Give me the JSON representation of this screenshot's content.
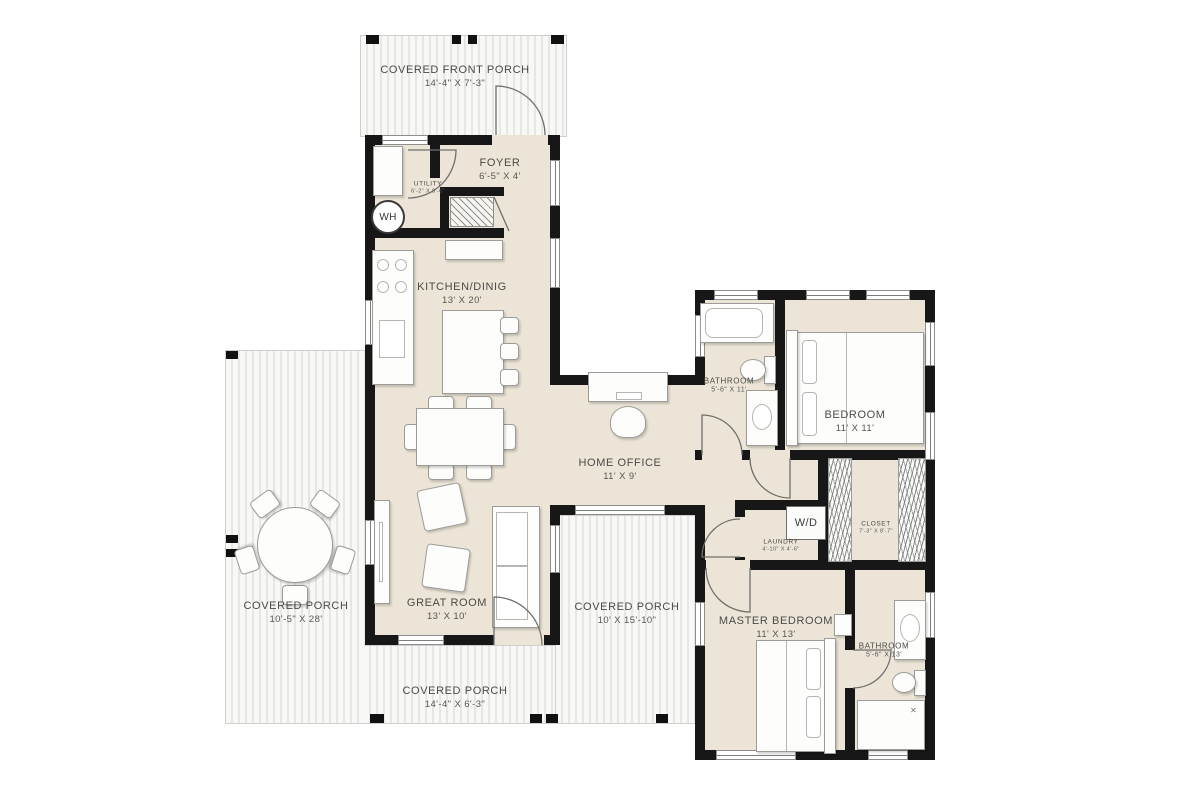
{
  "floorplan": {
    "rooms": [
      {
        "id": "covered-front-porch",
        "name": "COVERED FRONT PORCH",
        "dims": "14'-4\" X 7'-3\""
      },
      {
        "id": "foyer",
        "name": "FOYER",
        "dims": "6'-5\" X 4'"
      },
      {
        "id": "utility",
        "name": "UTILITY",
        "dims": "6'-2\" X 8'-6\""
      },
      {
        "id": "kitchen-dining",
        "name": "KITCHEN/DINIG",
        "dims": "13' X 20'"
      },
      {
        "id": "home-office",
        "name": "HOME OFFICE",
        "dims": "11' X 9'"
      },
      {
        "id": "bathroom-1",
        "name": "BATHROOM",
        "dims": "5'-6\" X 11'"
      },
      {
        "id": "bedroom",
        "name": "BEDROOM",
        "dims": "11' X 11'"
      },
      {
        "id": "laundry",
        "name": "LAUNDRY",
        "dims": "4'-10\" X 4'-6\""
      },
      {
        "id": "closet",
        "name": "CLOSET",
        "dims": "7'-3\" X 8'-7\""
      },
      {
        "id": "great-room",
        "name": "GREAT ROOM",
        "dims": "13' X 10'"
      },
      {
        "id": "covered-porch-left",
        "name": "COVERED PORCH",
        "dims": "10'-5\" X 28'"
      },
      {
        "id": "covered-porch-mid",
        "name": "COVERED PORCH",
        "dims": "10' X 15'-10\""
      },
      {
        "id": "master-bedroom",
        "name": "MASTER BEDROOM",
        "dims": "11' X 13'"
      },
      {
        "id": "bathroom-2",
        "name": "BATHROOM",
        "dims": "5'-6\" X 13'"
      },
      {
        "id": "covered-porch-bottom",
        "name": "COVERED PORCH",
        "dims": "14'-4\" X 6'-3\""
      }
    ],
    "labels": {
      "water_heater": "WH",
      "washer_dryer": "W/D"
    },
    "colors": {
      "wall": "#171717",
      "floor": "#ece5d7",
      "porch_plank": "#e6e6e3",
      "text": "#4a4a48"
    }
  }
}
